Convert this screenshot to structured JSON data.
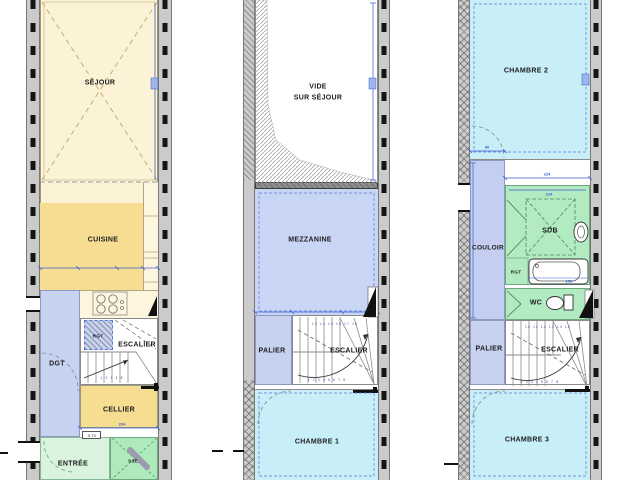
{
  "palette": {
    "sejour_cream": "#fcf2d6",
    "kitchen_gold": "#f6dd91",
    "counter_pale": "#fdf5de",
    "circulation_blue": "#c7d1f0",
    "mezzanine_blue": "#c9d5f4",
    "bedroom_cyan": "#c8eef8",
    "bath_green": "#b2ebc2",
    "entry_green": "#d9f3de",
    "wall_gray": "#cbcbcb",
    "dimension_blue": "#3a5bd0"
  },
  "ground": {
    "sejour": "SÉJOUR",
    "cuisine": "CUISINE",
    "rgt": "RGT",
    "escalier": "ESCALIER",
    "dgt": "DGT",
    "cellier": "CELLIER",
    "cellier_dim": "204",
    "door_width": "0.73",
    "entree": "ENTRÉE",
    "sde": "SdE",
    "stair_steps": "1 2 3 4 5"
  },
  "first": {
    "vide_line1": "VIDE",
    "vide_line2": "SUR SÉJOUR",
    "mezzanine": "MEZZANINE",
    "palier": "PALIER",
    "escalier": "ESCALIER",
    "chambre1": "CHAMBRE 1",
    "stair_steps_top": "13 14 15 16 17 18",
    "stair_steps_bottom": "1 2 3 4 5 6 7 8"
  },
  "second": {
    "chambre2": "CHAMBRE 2",
    "dim_90": "90",
    "dim_224_a": "224",
    "dim_224_b": "224",
    "couloir": "COULOIR",
    "sdb": "SDB",
    "rgt": "RGT",
    "dim_158": "158",
    "wc": "WC",
    "palier": "PALIER",
    "escalier": "ESCALIER",
    "chambre3": "CHAMBRE 3",
    "stair_steps_top": "10 11 12 13 14 15",
    "stair_steps_bottom": "1 2 3 4 5 6 7 8"
  }
}
